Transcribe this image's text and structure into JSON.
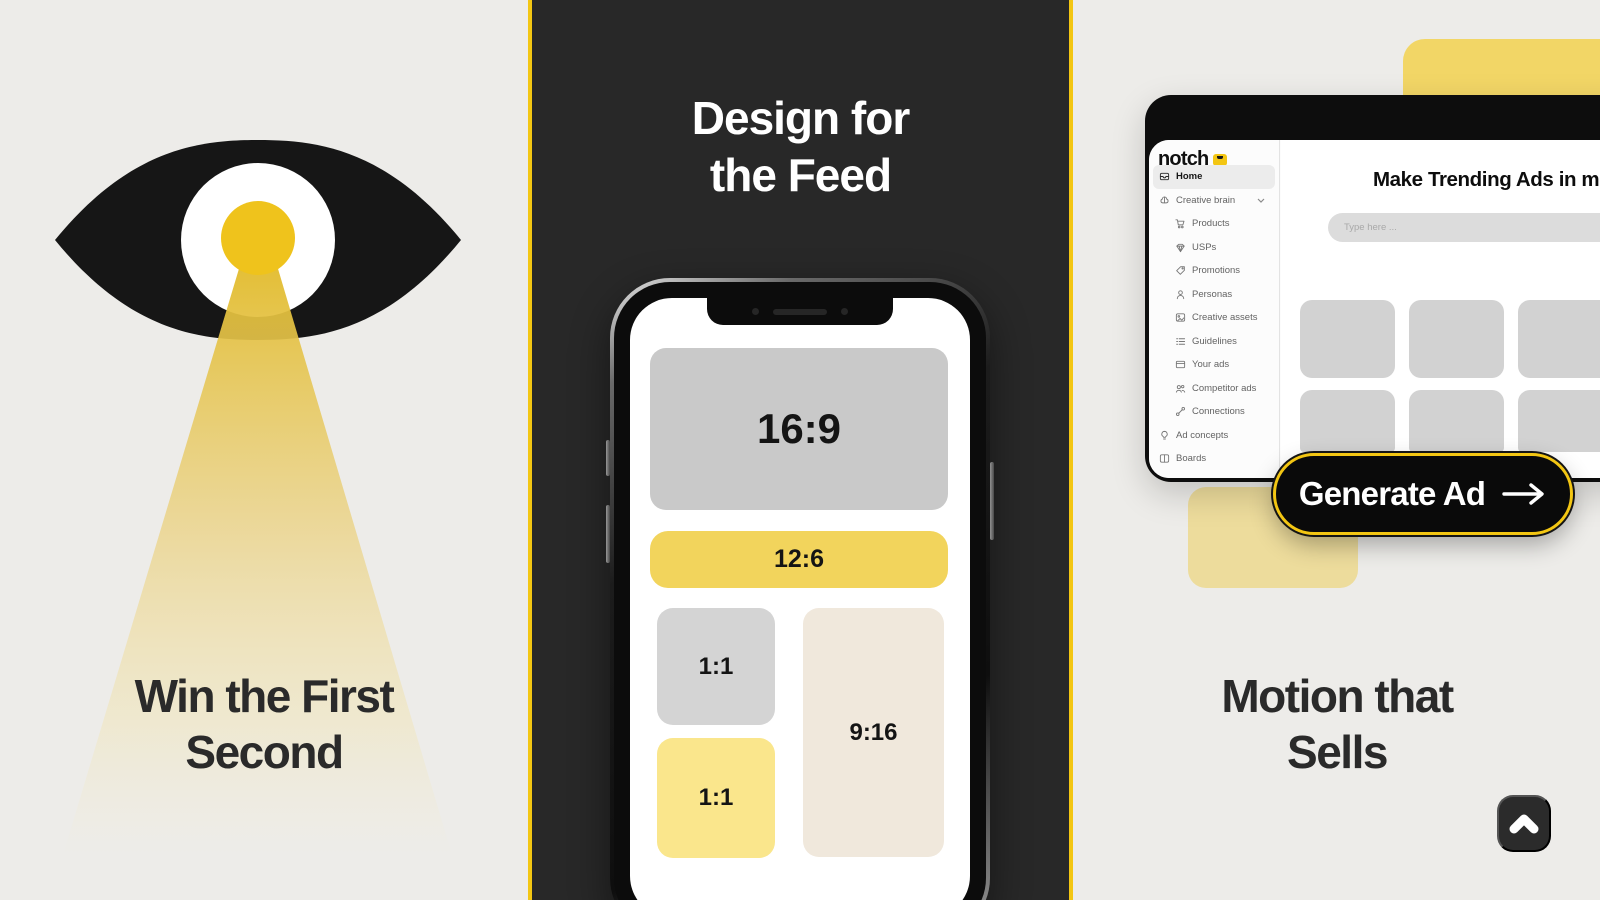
{
  "colors": {
    "accent_yellow": "#F3C613",
    "pupil_yellow": "#EFC31C",
    "banner_yellow": "#F2D45C",
    "tile_light_yellow": "#FAE68C",
    "tile_beige": "#F0E8DC",
    "soft_yellow_block": "#EDDC9C",
    "top_yellow_block": "#F2D666",
    "dark_panel": "#282828",
    "paper_background": "#EDECE9",
    "window_black": "#0D0D0D"
  },
  "left_panel": {
    "illustration": "eye-with-light-beam",
    "headline": [
      "Win the First",
      "Second"
    ]
  },
  "middle_panel": {
    "headline": [
      "Design for",
      "the Feed"
    ],
    "phone_tiles": {
      "wide": "16:9",
      "banner": "12:6",
      "square_top": "1:1",
      "square_bottom": "1:1",
      "vertical": "9:16"
    }
  },
  "right_panel": {
    "headline": [
      "Motion that",
      "Sells"
    ],
    "app_window": {
      "logo": "notch",
      "sidebar": {
        "items": [
          {
            "label": "Home",
            "icon": "home-icon",
            "active": true
          },
          {
            "label": "Creative brain",
            "icon": "brain-icon",
            "expandable": true
          },
          {
            "label": "Products",
            "icon": "cart-icon"
          },
          {
            "label": "USPs",
            "icon": "gem-icon"
          },
          {
            "label": "Promotions",
            "icon": "tag-icon"
          },
          {
            "label": "Personas",
            "icon": "persona-icon"
          },
          {
            "label": "Creative assets",
            "icon": "image-icon"
          },
          {
            "label": "Guidelines",
            "icon": "checklist-icon"
          },
          {
            "label": "Your ads",
            "icon": "browser-icon"
          },
          {
            "label": "Competitor ads",
            "icon": "users-icon"
          },
          {
            "label": "Connections",
            "icon": "link-icon"
          },
          {
            "label": "Ad concepts",
            "icon": "lightbulb-icon"
          },
          {
            "label": "Boards",
            "icon": "board-icon"
          }
        ]
      },
      "main": {
        "heading": "Make Trending Ads in minutes",
        "input_placeholder": "Type here ...",
        "placeholder_tile_count": 6
      }
    },
    "generate_button": {
      "label": "Generate Ad",
      "icon": "arrow-right-icon"
    },
    "scroll_top_button": {
      "icon": "chevron-up-icon"
    }
  }
}
